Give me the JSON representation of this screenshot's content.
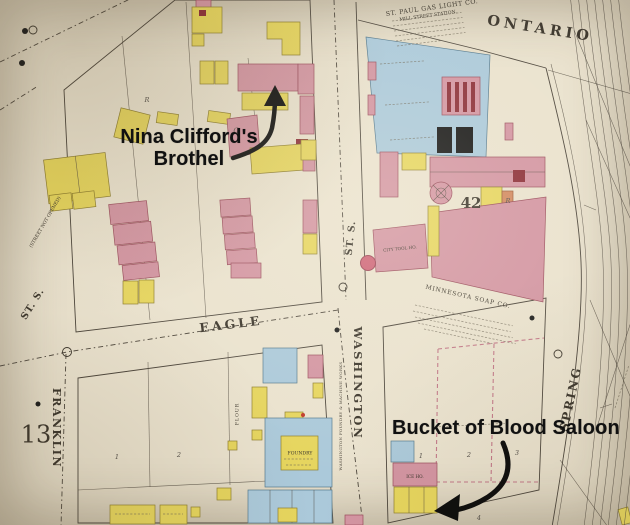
{
  "annotations": {
    "brothel": {
      "label": "Nina Clifford's Brothel",
      "line1": "Nina Clifford's",
      "line2": "Brothel"
    },
    "saloon": {
      "label": "Bucket of Blood Saloon"
    }
  },
  "streets": {
    "ontario": "ONTARIO",
    "eagle": "EAGLE",
    "washington": "WASHINGTON",
    "franklin": "FRANKLIN",
    "spring": "SPRING",
    "st_s_west": "ST. S.",
    "st_s_mid": "ST. S.",
    "street_not_opened": "(STREET NOT OPENED)"
  },
  "landmarks": {
    "gas_company": "ST. PAUL GAS LIGHT CO.",
    "gas_station": "MILL STREET STATION.",
    "soap_company": "MINNESOTA SOAP CO.",
    "foundry_works": "WASHINGTON FOUNDRY & MACHINE WORKS",
    "foundry": "FOUNDRY",
    "city_tool_house": "CITY TOOL HO.",
    "ice_house": "ICE HO.",
    "flour": "FLOUR"
  },
  "district_numbers": {
    "west": "13",
    "east": "42"
  },
  "lot_numbers": {
    "sw_lot1": "1",
    "sw_lot2": "2",
    "se_lot1": "1",
    "se_lot2": "2",
    "se_lot3": "3",
    "se_lot4": "4"
  },
  "building_letters": {
    "c": "C",
    "r_west": "R",
    "r_east": "R"
  },
  "colors": {
    "map_bg": "#eae2ce",
    "building_pink": "#d395a2",
    "building_yellow": "#e6d55e",
    "building_blue": "#abc9da",
    "accent_dark_red": "#8c2f38",
    "line": "#4d463c",
    "lot_dash_pink": "#c27888",
    "annotation_black": "#111111"
  }
}
